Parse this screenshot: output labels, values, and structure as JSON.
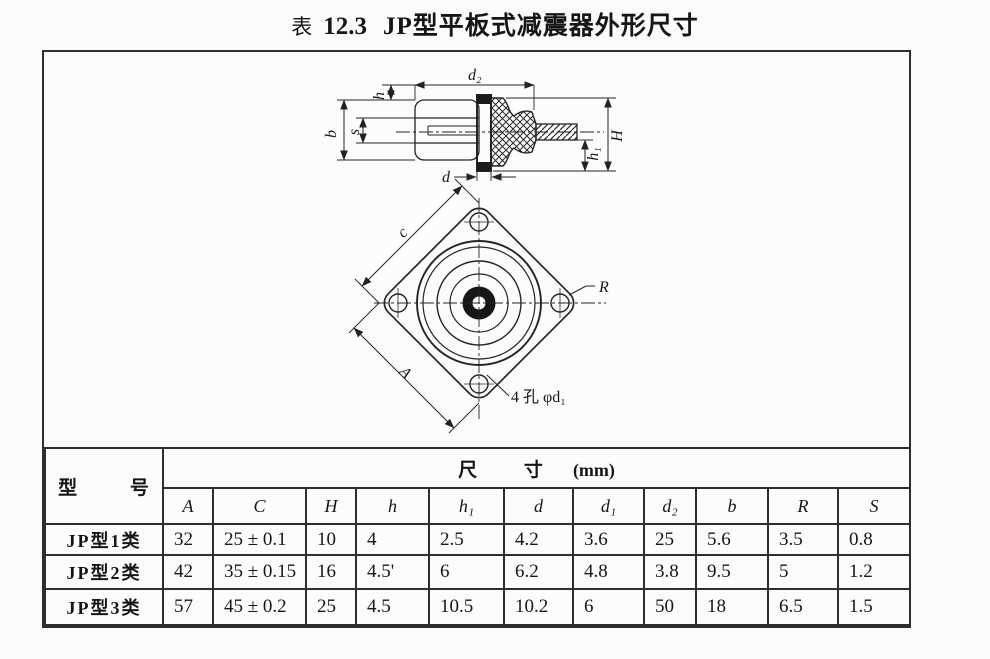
{
  "title": {
    "label": "表",
    "number": "12.3",
    "name": "JP型平板式减震器外形尺寸"
  },
  "drawing": {
    "side_view": {
      "d2": "d₂",
      "h": "h",
      "b": "b",
      "s": "s",
      "H": "H",
      "h1": "h₁",
      "d": "d"
    },
    "plan_view": {
      "c": "c",
      "A": "A",
      "R": "R",
      "hole_note": "4 孔 φd₁"
    }
  },
  "table": {
    "model_header": "型 号",
    "size_header": "尺 寸",
    "size_unit": "(mm)",
    "columns": [
      "A",
      "C",
      "H",
      "h",
      "h₁",
      "d",
      "d₁",
      "d₂",
      "b",
      "R",
      "S"
    ],
    "rows": [
      {
        "model": "JP型1类",
        "values": [
          "32",
          "25 ± 0.1",
          "10",
          "4",
          "2.5",
          "4.2",
          "3.6",
          "25",
          "5.6",
          "3.5",
          "0.8"
        ]
      },
      {
        "model": "JP型2类",
        "values": [
          "42",
          "35 ± 0.15",
          "16",
          "4.5'",
          "6",
          "6.2",
          "4.8",
          "3.8",
          "9.5",
          "5",
          "1.2"
        ]
      },
      {
        "model": "JP型3类",
        "values": [
          "57",
          "45 ± 0.2",
          "25",
          "4.5",
          "10.5",
          "10.2",
          "6",
          "50",
          "18",
          "6.5",
          "1.5"
        ]
      }
    ]
  }
}
